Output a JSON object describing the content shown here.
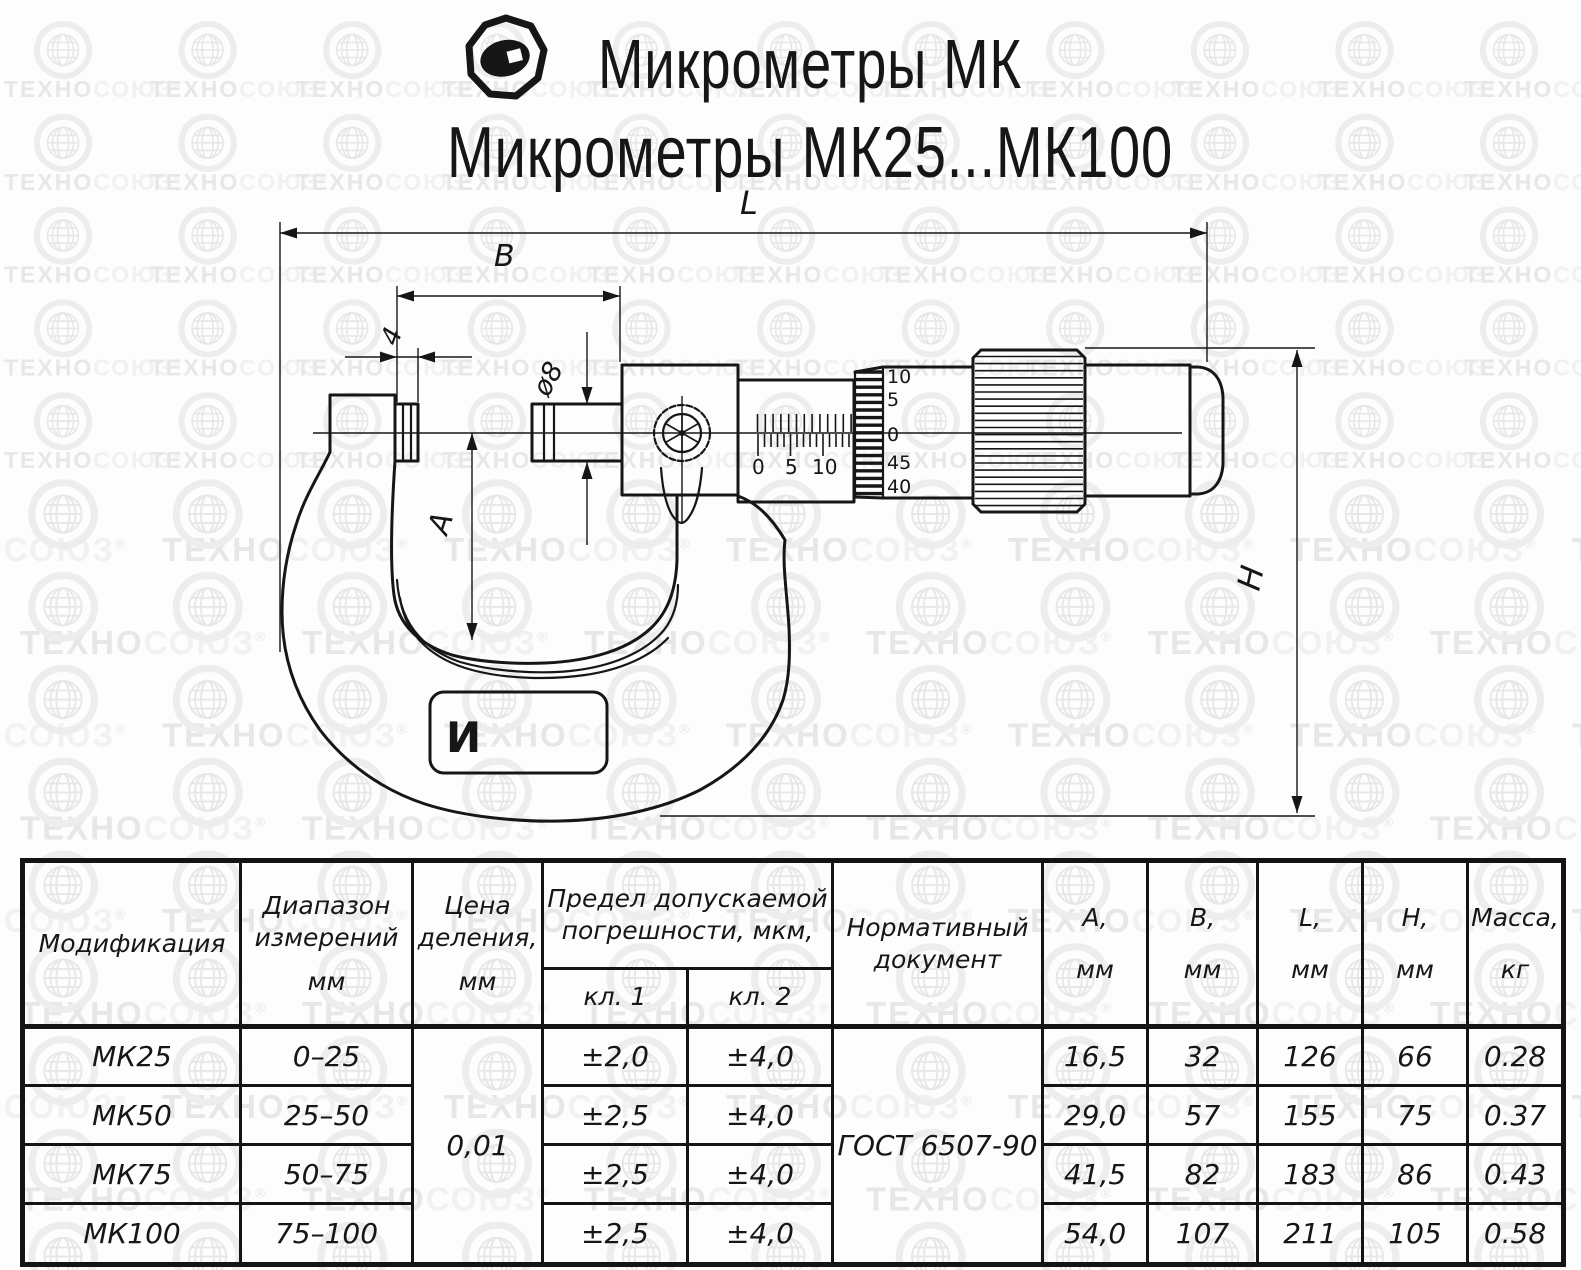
{
  "title": {
    "line1": "Микрометры МК",
    "line2": "Микрометры МК25...МК100"
  },
  "watermark": {
    "text_a": "ТЕХНО",
    "text_b": "СОЮЗ",
    "reg": "®"
  },
  "drawing": {
    "dims": {
      "L": "L",
      "B": "B",
      "four": "4",
      "dia": "ø8",
      "A": "A",
      "H": "H"
    },
    "sleeve_scale_labels": [
      "0",
      "5",
      "10"
    ],
    "thimble_scale_labels": [
      "10",
      "5",
      "0",
      "45",
      "40"
    ],
    "frame_mark": "И"
  },
  "table": {
    "headers": {
      "modification": "Модификация",
      "range_l1": "Диапазон",
      "range_l2": "измерений",
      "range_l3": "мм",
      "division_l1": "Цена",
      "division_l2": "деления,",
      "division_l3": "мм",
      "error_l1": "Предел допускаемой",
      "error_l2": "погрешности, мкм,",
      "class1": "кл. 1",
      "class2": "кл. 2",
      "document_l1": "Нормативный",
      "document_l2": "документ",
      "A_l1": "А,",
      "A_l2": "мм",
      "B_l1": "В,",
      "B_l2": "мм",
      "L_l1": "L,",
      "L_l2": "мм",
      "H_l1": "Н,",
      "H_l2": "мм",
      "mass_l1": "Масса,",
      "mass_l2": "кг"
    },
    "division_value": "0,01",
    "document_value": "ГОСТ 6507-90",
    "rows": [
      {
        "model": "МК25",
        "range": "0–25",
        "cl1": "±2,0",
        "cl2": "±4,0",
        "A": "16,5",
        "B": "32",
        "L": "126",
        "H": "66",
        "mass": "0.28"
      },
      {
        "model": "МК50",
        "range": "25–50",
        "cl1": "±2,5",
        "cl2": "±4,0",
        "A": "29,0",
        "B": "57",
        "L": "155",
        "H": "75",
        "mass": "0.37"
      },
      {
        "model": "МК75",
        "range": "50–75",
        "cl1": "±2,5",
        "cl2": "±4,0",
        "A": "41,5",
        "B": "82",
        "L": "183",
        "H": "86",
        "mass": "0.43"
      },
      {
        "model": "МК100",
        "range": "75–100",
        "cl1": "±2,5",
        "cl2": "±4,0",
        "A": "54,0",
        "B": "107",
        "L": "211",
        "H": "105",
        "mass": "0.58"
      }
    ]
  }
}
